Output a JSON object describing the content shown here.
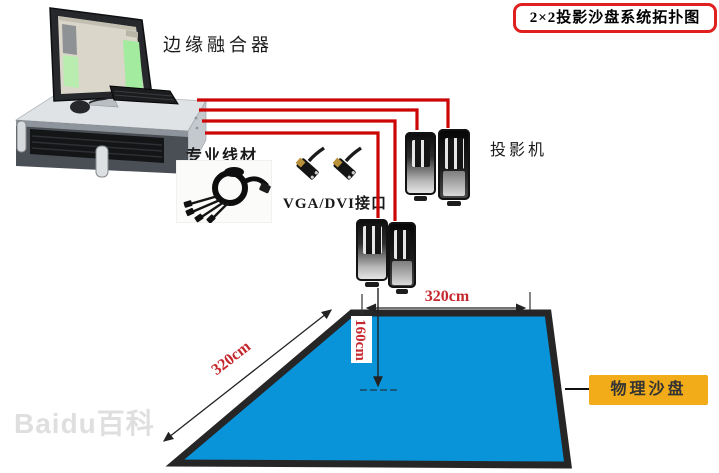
{
  "title": {
    "text": "2×2投影沙盘系统拓扑图"
  },
  "labels": {
    "edge_fusion_device": "边缘融合器",
    "professional_cable": "专业线材",
    "vga_dvi_interface": "VGA/DVI接口",
    "projector": "投影机",
    "physical_sand_table": "物理沙盘"
  },
  "dimensions": {
    "table_top_width": "320cm",
    "table_left_depth": "320cm",
    "projection_height": "160cm"
  },
  "watermark": "Baidu百科",
  "colors": {
    "title_border_red": "#e01f1f",
    "cable_line_red": "#cc0505",
    "sand_table_blue": "#0994da",
    "sand_table_border": "#262626",
    "sand_label_yellow": "#f2ac19",
    "dimension_text_red": "#c5272d"
  },
  "topology": {
    "system": "2×2投影沙盘",
    "source_device": "边缘融合器",
    "output_lines": 4,
    "projector_count": 4,
    "projection_target": "物理沙盘",
    "table_size": "320cm × 320cm",
    "projection_height": "160cm"
  }
}
